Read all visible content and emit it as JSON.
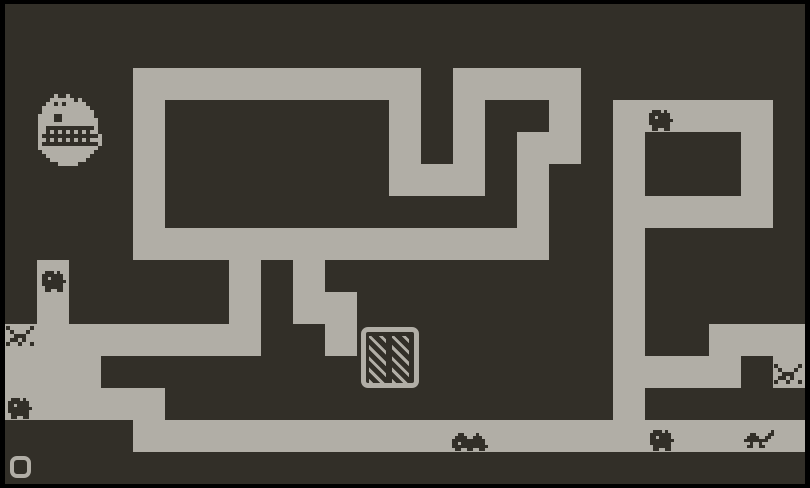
{
  "game": {
    "name": "maze-roguelike-screen",
    "colors": {
      "frame": "#000000",
      "wall_dark": "#322f28",
      "path_light": "#b1aea6"
    },
    "stage": {
      "width": 810,
      "height": 488
    },
    "grid": {
      "cell": 32,
      "offset_x": 5,
      "offset_y": 4,
      "cols": 25,
      "rows": 15,
      "legend": {
        "#": "path",
        ".": "wall"
      },
      "map": [
        ".........................",
        ".........................",
        "....#########.####.......",
        "....#.......#.#..#.#####.",
        "....#.......#.#.##.#...#.",
        "....#.......###.#..#...#.",
        "....#...........#..#####.",
        "....#############..#.....",
        ".#.....#.#.........#.....",
        ".#.....#.##........#.....",
        "########..#........#..###",
        "###................####.#",
        "#####..............#.....",
        "....#####################",
        "........................."
      ]
    },
    "door": {
      "label": "hatched-grate-door",
      "x": 361,
      "y": 327,
      "width": 58,
      "height": 61,
      "frame_thickness": 5,
      "corner_radius": 7,
      "panel": {
        "top": 4,
        "height": 47,
        "width": 17,
        "left_inset": 3,
        "center_gap": 6,
        "stripe_light": 3,
        "stripe_dark": 5,
        "stripe_angle_deg": 45
      }
    },
    "player": {
      "label": "player-ring",
      "x": 10,
      "y": 456,
      "width": 21,
      "height": 22,
      "ring_thickness": 4,
      "corner_radius": 7
    },
    "sprites": [
      {
        "name": "boss-monster-sprite",
        "x": 38,
        "y": 94,
        "px": 4,
        "color": "path_light",
        "rows": [
          "....X..X.........",
          "...XXXXXX.X......",
          "..XX.X.XXXXX.....",
          ".XXXXXXXXXXXX....",
          ".XXXXXXXXXXXXX...",
          "XXXX..XXXXXXXX...",
          "XXXX..XXXXXXXXX..",
          "XXXXXXXXXXXXXXX..",
          "XX............X..",
          "XX.X.X.X.X.X.XX..",
          "X..............X.",
          "XX.X.X.X.X.X.XXX.",
          "X..............X.",
          "XXXXXXXXXXXXXXX..",
          ".XXXXXXXXXXXXX...",
          "..XXXXXXXXXXX....",
          "...XXXXXXXXX.....",
          ".....XXXXX......."
        ]
      },
      {
        "name": "snail-creature-sprite",
        "x": 298,
        "y": 175,
        "px": 3,
        "color": "wall_dark",
        "rows": [
          ".XXX.X..",
          "XXXXXXX.",
          "XX.XXXX.",
          "XXXXXXXX",
          "XXXXXXX.",
          ".XXXXXX.",
          ".XX..XX."
        ]
      },
      {
        "name": "snail-creature-sprite",
        "x": 649,
        "y": 110,
        "px": 3,
        "color": "wall_dark",
        "rows": [
          ".XXX.X..",
          "XXXXXXX.",
          "XX.XXXX.",
          "XXXXXXXX",
          "XXXXXXX.",
          ".XXXXXX.",
          ".XX..XX."
        ]
      },
      {
        "name": "snail-creature-sprite",
        "x": 42,
        "y": 271,
        "px": 3,
        "color": "wall_dark",
        "rows": [
          ".XXX.X..",
          "XXXXXXX.",
          "XX.XXXX.",
          "XXXXXXXX",
          "XXXXXXX.",
          ".XXXXXX.",
          ".XX..XX."
        ]
      },
      {
        "name": "snail-creature-sprite",
        "x": 8,
        "y": 398,
        "px": 3,
        "color": "wall_dark",
        "rows": [
          ".XXX.X..",
          "XXXXXXX.",
          "XX.XXXX.",
          "XXXXXXXX",
          "XXXXXXX.",
          ".XXXXXX.",
          ".XX..XX."
        ]
      },
      {
        "name": "snail-creature-sprite",
        "x": 650,
        "y": 430,
        "px": 3,
        "color": "wall_dark",
        "rows": [
          ".XXX.X..",
          "XXXXXXX.",
          "XX.XXXX.",
          "XXXXXXXX",
          "XXXXXXX.",
          ".XXXXXX.",
          ".XX..XX."
        ]
      },
      {
        "name": "wide-snail-creature-sprite",
        "x": 452,
        "y": 433,
        "px": 3,
        "color": "wall_dark",
        "rows": [
          "..XX....X...",
          ".XXXX..XXX..",
          "XXXXXXXXXXX.",
          "XX.XXXXXXXX.",
          "XXXXXXXXXXXX",
          ".XX..XX..XX."
        ]
      },
      {
        "name": "bones-creature-sprite",
        "x": 744,
        "y": 430,
        "px": 3,
        "color": "wall_dark",
        "rows": [
          ".........X",
          "..XX....XX",
          ".XXXX..XX.",
          "XXXXXXXX..",
          "..X..X....",
          ".XX..XX..."
        ]
      },
      {
        "name": "spike-trap-sprite",
        "x": 6,
        "y": 326,
        "px": 4,
        "color": "wall_dark",
        "rows": [
          "X.....X",
          ".X...X.",
          "..XXX..",
          ".XX.X..",
          "X..X..X"
        ]
      },
      {
        "name": "spike-trap-sprite",
        "x": 774,
        "y": 364,
        "px": 4,
        "color": "wall_dark",
        "rows": [
          "X.....X",
          ".X...X.",
          "..XXX..",
          ".XX.X..",
          "X..X..X"
        ]
      }
    ]
  }
}
